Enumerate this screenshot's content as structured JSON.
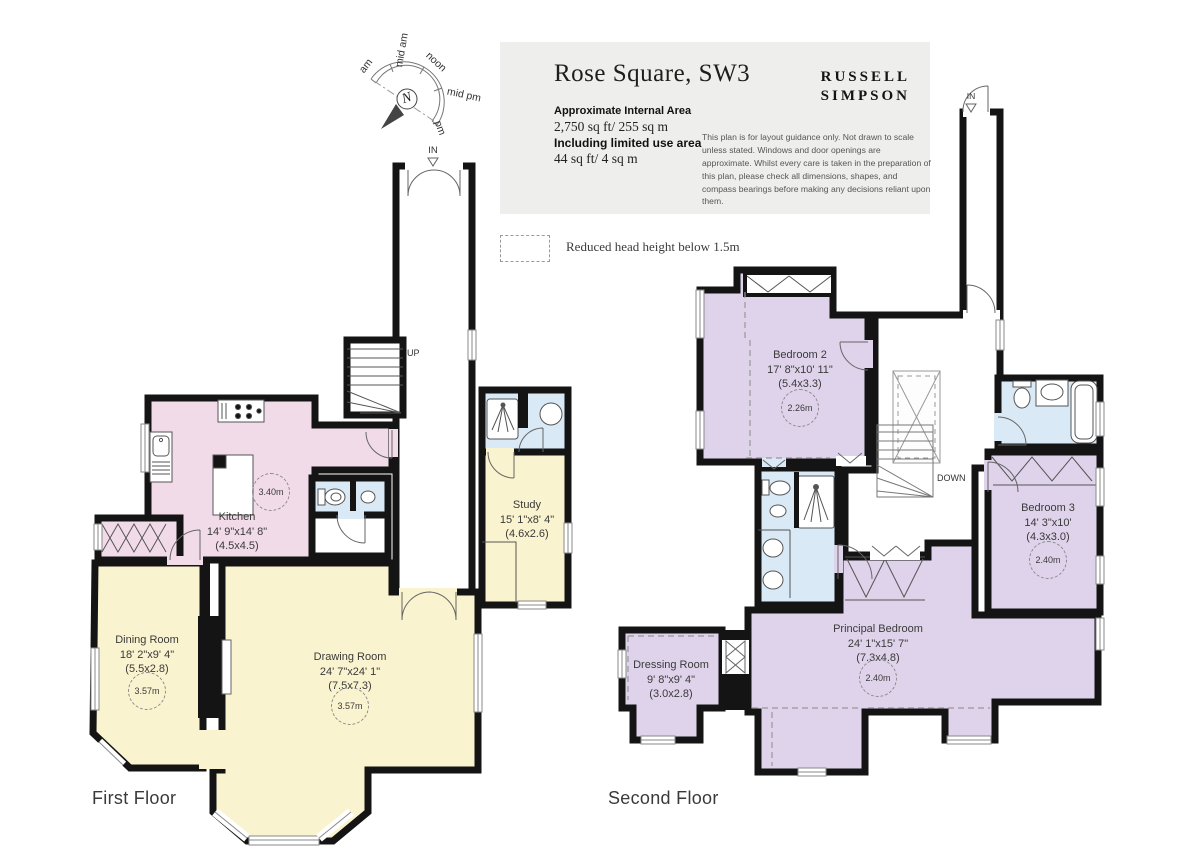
{
  "header": {
    "title": "Rose Square, SW3",
    "brand_line1": "RUSSELL",
    "brand_line2": "SIMPSON",
    "area_heading": "Approximate Internal Area",
    "area_value": "2,750 sq ft/ 255 sq m",
    "limited_heading": "Including limited use area",
    "limited_value": "44 sq ft/ 4 sq m",
    "disclaimer": "This plan is for layout guidance only. Not drawn to scale unless stated. Windows and door openings are approximate. Whilst every care is taken in the preparation of this plan, please check all dimensions, shapes, and compass bearings before making any decisions reliant upon them."
  },
  "legend": {
    "reduced_head_height": "Reduced head height below 1.5m"
  },
  "compass": {
    "label_am": "am",
    "label_mid_am": "mid am",
    "label_noon": "noon",
    "label_mid_pm": "mid pm",
    "label_pm": "pm",
    "north": "N"
  },
  "floors": {
    "first": {
      "label": "First Floor",
      "entrance_label": "IN",
      "stairs_label": "UP",
      "rooms": {
        "kitchen": {
          "name": "Kitchen",
          "dims": "14' 9\"x14' 8\"",
          "metric": "(4.5x4.5)",
          "ceiling_height": "3.40m"
        },
        "dining_room": {
          "name": "Dining Room",
          "dims": "18' 2\"x9' 4\"",
          "metric": "(5.5x2.8)",
          "ceiling_height": "3.57m"
        },
        "drawing_room": {
          "name": "Drawing Room",
          "dims": "24' 7\"x24' 1\"",
          "metric": "(7.5x7.3)",
          "ceiling_height": "3.57m"
        },
        "study": {
          "name": "Study",
          "dims": "15' 1\"x8' 4\"",
          "metric": "(4.6x2.6)"
        }
      }
    },
    "second": {
      "label": "Second Floor",
      "entrance_label": "IN",
      "stairs_label": "DOWN",
      "rooms": {
        "bedroom_2": {
          "name": "Bedroom 2",
          "dims": "17' 8\"x10' 11\"",
          "metric": "(5.4x3.3)",
          "ceiling_height": "2.26m"
        },
        "bedroom_3": {
          "name": "Bedroom 3",
          "dims": "14' 3\"x10'",
          "metric": "(4.3x3.0)",
          "ceiling_height": "2.40m"
        },
        "principal_bedroom": {
          "name": "Principal Bedroom",
          "dims": "24' 1\"x15' 7\"",
          "metric": "(7.3x4.8)",
          "ceiling_height": "2.40m"
        },
        "dressing_room": {
          "name": "Dressing Room",
          "dims": "9' 8\"x9' 4\"",
          "metric": "(3.0x2.8)"
        }
      }
    }
  },
  "colors": {
    "reception_yellow": "#faf3cf",
    "kitchen_pink": "#f2dbe9",
    "bedroom_purple": "#ded3ea",
    "bathroom_blue": "#d9e9f6",
    "wall_black": "#141414",
    "header_panel_grey": "#eeeeec"
  }
}
